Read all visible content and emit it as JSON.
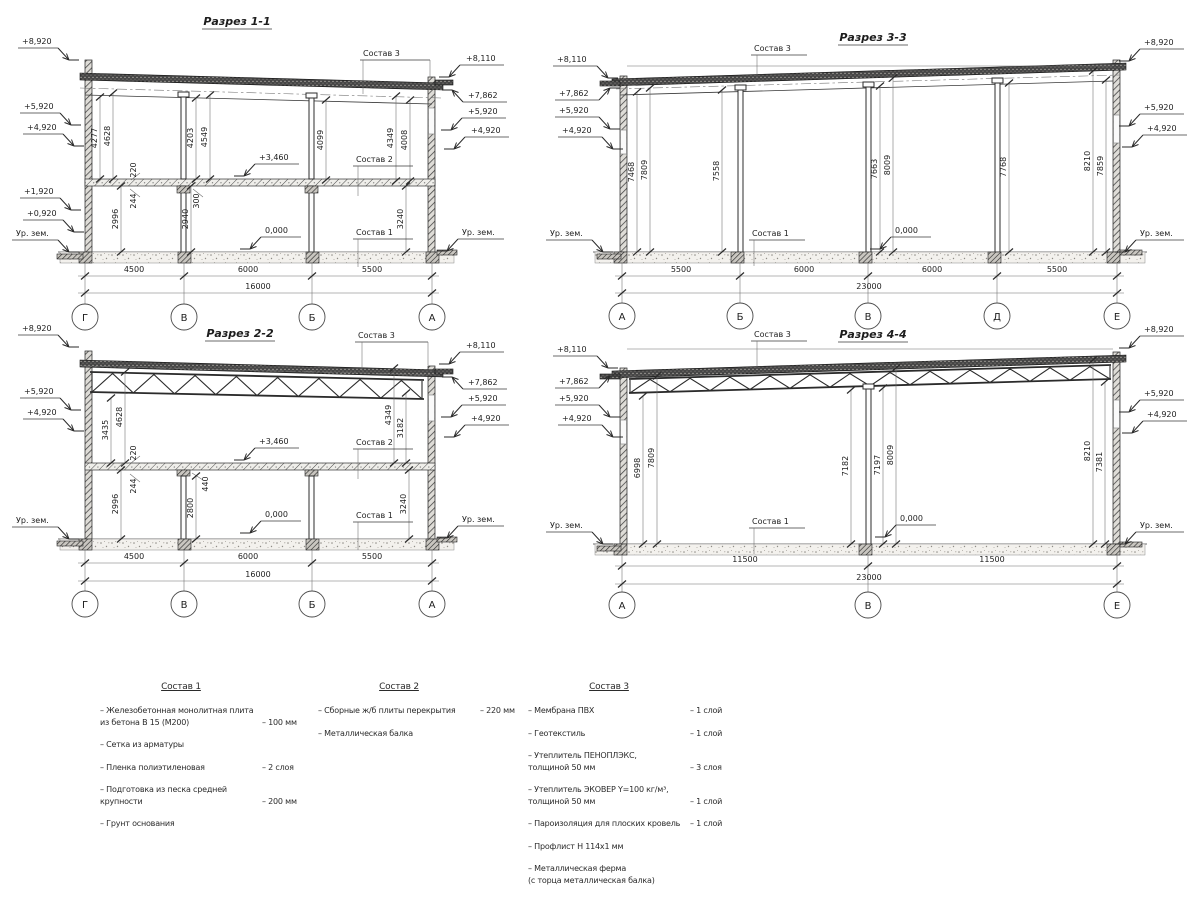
{
  "page": {
    "background": "#ffffff",
    "line_color": "#2a2a2a",
    "text_color": "#1d1d1d"
  },
  "sections": {
    "s1": {
      "title": "Разрез 1-1",
      "left_levels": [
        "+8,920",
        "+5,920",
        "+4,920",
        "+1,920",
        "+0,920",
        "Ур. зем."
      ],
      "right_levels": [
        "+8,110",
        "+7,862",
        "+5,920",
        "+4,920",
        "Ур. зем."
      ],
      "inner_levels": [
        "+3,460",
        "0,000"
      ],
      "callouts": [
        "Состав 3",
        "Состав 2",
        "Состав 1"
      ],
      "vdims": [
        "4277",
        "4628",
        "4203",
        "4549",
        "4099",
        "4349",
        "4008",
        "220",
        "244",
        "300",
        "2996",
        "2940",
        "3240"
      ],
      "hdims": [
        "4500",
        "6000",
        "5500"
      ],
      "total": "16000",
      "grids": [
        "Г",
        "В",
        "Б",
        "А"
      ]
    },
    "s2": {
      "title": "Разрез 2-2",
      "left_levels": [
        "+8,920",
        "+5,920",
        "+4,920",
        "Ур. зем."
      ],
      "right_levels": [
        "+8,110",
        "+7,862",
        "+5,920",
        "+4,920",
        "Ур. зем."
      ],
      "inner_levels": [
        "+3,460",
        "0,000"
      ],
      "callouts": [
        "Состав 3",
        "Состав 2",
        "Состав 1"
      ],
      "vdims": [
        "3435",
        "4628",
        "220",
        "244",
        "2996",
        "440",
        "2800",
        "4349",
        "3182",
        "3240"
      ],
      "hdims": [
        "4500",
        "6000",
        "5500"
      ],
      "total": "16000",
      "grids": [
        "Г",
        "В",
        "Б",
        "А"
      ]
    },
    "s3": {
      "title": "Разрез 3-3",
      "left_levels": [
        "+8,110",
        "+7,862",
        "+5,920",
        "+4,920",
        "Ур. зем."
      ],
      "right_levels": [
        "+8,920",
        "+5,920",
        "+4,920",
        "Ур. зем."
      ],
      "inner_levels": [
        "0,000"
      ],
      "callouts": [
        "Состав 3",
        "Состав 1"
      ],
      "vdims": [
        "7468",
        "7809",
        "7558",
        "7663",
        "8009",
        "7768",
        "8210",
        "7859"
      ],
      "hdims": [
        "5500",
        "6000",
        "6000",
        "5500"
      ],
      "total": "23000",
      "grids": [
        "А",
        "Б",
        "В",
        "Д",
        "Е"
      ]
    },
    "s4": {
      "title": "Разрез 4-4",
      "left_levels": [
        "+8,110",
        "+7,862",
        "+5,920",
        "+4,920",
        "Ур. зем."
      ],
      "right_levels": [
        "+8,920",
        "+5,920",
        "+4,920",
        "Ур. зем."
      ],
      "inner_levels": [
        "0,000"
      ],
      "callouts": [
        "Состав 3",
        "Состав 1"
      ],
      "vdims": [
        "6998",
        "7809",
        "7182",
        "7197",
        "8009",
        "8210",
        "7381"
      ],
      "hdims": [
        "11500",
        "11500"
      ],
      "total": "23000",
      "grids": [
        "А",
        "В",
        "Е"
      ]
    }
  },
  "legend": {
    "c1": {
      "title": "Состав 1",
      "items": [
        {
          "lines": [
            "– Железобетонная  монолитная плита",
            "из бетона В 15 (М200)"
          ],
          "value": "– 100 мм"
        },
        {
          "lines": [
            "– Сетка из арматуры"
          ],
          "value": ""
        },
        {
          "lines": [
            "– Пленка полиэтиленовая"
          ],
          "value": "–  2 слоя"
        },
        {
          "lines": [
            "– Подготовка из песка средней",
            "крупности"
          ],
          "value": "– 200 мм"
        },
        {
          "lines": [
            "– Грунт основания"
          ],
          "value": ""
        }
      ]
    },
    "c2": {
      "title": "Состав 2",
      "items": [
        {
          "lines": [
            "– Сборные ж/б плиты перекрытия"
          ],
          "value": "– 220 мм"
        },
        {
          "lines": [
            "– Металлическая балка"
          ],
          "value": ""
        }
      ]
    },
    "c3": {
      "title": "Состав 3",
      "items": [
        {
          "lines": [
            "– Мембрана ПВХ"
          ],
          "value": "– 1 слой"
        },
        {
          "lines": [
            "– Геотекстиль"
          ],
          "value": "– 1 слой"
        },
        {
          "lines": [
            "– Утеплитель ПЕНОПЛЭКС,",
            "толщиной 50 мм"
          ],
          "value": "– 3 слоя"
        },
        {
          "lines": [
            "– Утеплитель ЭКОВЕР Y=100 кг/м³,",
            "толщиной 50 мм"
          ],
          "value": "– 1 слой"
        },
        {
          "lines": [
            "– Пароизоляция для плоских кровель"
          ],
          "value": "– 1 слой"
        },
        {
          "lines": [
            "– Профлист Н 114х1 мм"
          ],
          "value": ""
        },
        {
          "lines": [
            "– Металлическая ферма",
            "(с торца металлическая балка)"
          ],
          "value": ""
        }
      ]
    }
  }
}
